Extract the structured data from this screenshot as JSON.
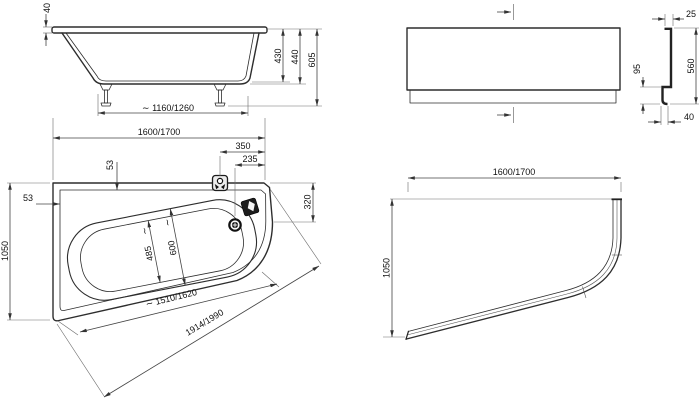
{
  "colors": {
    "line": "#2d2d2d",
    "dim": "#444444",
    "fixture": "#141414",
    "background": "#ffffff"
  },
  "views": {
    "side": {
      "rim_thickness": "40",
      "inner_depth": "430",
      "body_height": "440",
      "total_height": "605",
      "feet_spacing": "∼ 1160/1260",
      "length": "1600/1700"
    },
    "apron_front": {
      "top_lip": "25",
      "height": "560",
      "plinth": "95",
      "base_depth": "40"
    },
    "plan": {
      "rim_top": "53",
      "rim_left": "53",
      "fitting_offset": "350",
      "drain_offset": "235",
      "right_edge": "320",
      "width": "1050",
      "well_inner_width": "485",
      "well_outer_width": "600",
      "tilde": "∼",
      "well_length": "∼ 1510/1620",
      "diagonal": "1914/1990"
    },
    "apron_plan": {
      "length": "1600/1700",
      "width": "1050"
    }
  },
  "icons": {
    "overflow_fitting": "overflow-fitting-icon",
    "grab_handle": "grab-handle-icon",
    "drain": "drain-icon",
    "centerline": "centerline-mark-icon"
  }
}
